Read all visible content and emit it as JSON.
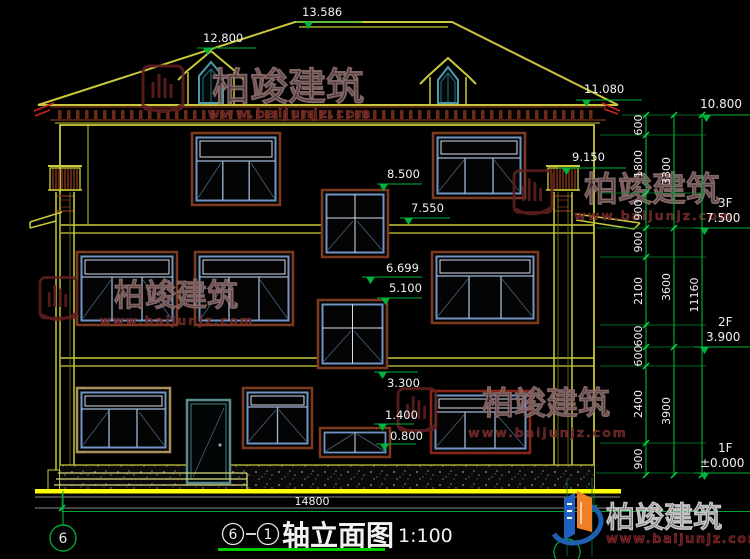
{
  "elev": {
    "v13586": "13.586",
    "v12800": "12.800",
    "v11080": "11.080",
    "v10800": "10.800",
    "v9150": "9.150",
    "v8500": "8.500",
    "v7550": "7.550",
    "v6699": "6.699",
    "v5100": "5.100",
    "v3300": "3.300",
    "v1400": "1.400",
    "v0800": "0.800"
  },
  "dims": {
    "inner": [
      "600",
      "1800",
      "900",
      "900",
      "2100",
      "600",
      "600",
      "2400",
      "900"
    ],
    "middle": [
      "3300",
      "3600",
      "3900"
    ],
    "total": "11160",
    "width": "14800"
  },
  "floors": [
    {
      "label": "3F",
      "elev": "7.500"
    },
    {
      "label": "2F",
      "elev": "3.900"
    },
    {
      "label": "1F",
      "elev": "±0.000"
    }
  ],
  "title": {
    "axis_a": "6",
    "axis_b": "1",
    "name": "轴立面图",
    "scale": "1:100"
  },
  "axis_bubble": "6",
  "watermark": {
    "cn": "柏竣建筑",
    "url": "www.baijunjz.com"
  },
  "logo": {
    "cn": "柏竣建筑",
    "url": "www.baijunjz.com"
  },
  "colors": {
    "outline_olive": "#c9c93a",
    "ground_yellow": "#ffff00",
    "dim_green": "#00b33c",
    "bright_green": "#00cc00",
    "trim_brown": "#7d3a1e",
    "trim_red": "#8a2618",
    "trim_tan": "#a8925a",
    "frame_blue": "#7095c5",
    "dormer_teal": "#4e9aaa",
    "eave_maroon": "#6b2a16",
    "watermark_red": "#5f1f1f",
    "logo_blue": "#1f5fc0",
    "logo_orange": "#f08025",
    "red_accent": "#cc2222"
  }
}
